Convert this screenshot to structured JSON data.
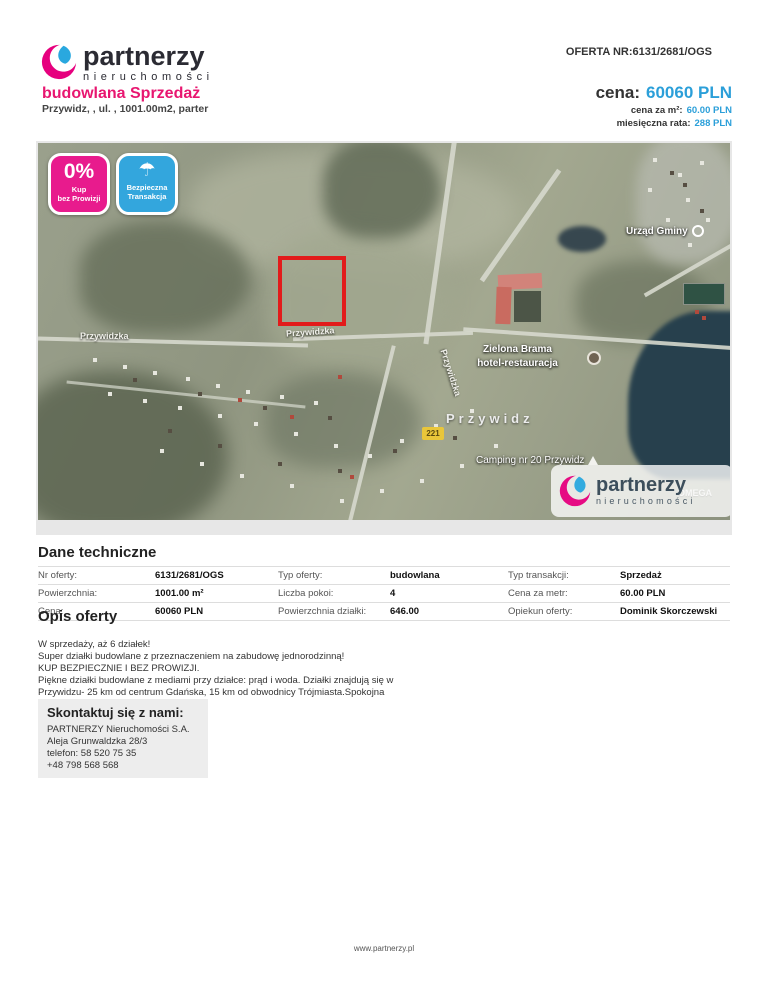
{
  "brand": {
    "name": "partnerzy",
    "subname": "nieruchomości"
  },
  "header": {
    "offer_number": "OFERTA NR:6131/2681/OGS",
    "title": "budowlana Sprzedaż",
    "subtitle": "Przywidz, , ul. , 1001.00m2, parter",
    "price_label": "cena:",
    "price_value": "60060 PLN",
    "price_per_m2_label": "cena za m²:",
    "price_per_m2_value": "60.00 PLN",
    "monthly_rate_label": "miesięczna rata:",
    "monthly_rate_value": "288 PLN"
  },
  "map": {
    "badge_no_commission": {
      "big": "0%",
      "line1": "Kup",
      "line2": "bez Prowizji"
    },
    "badge_safe": {
      "icon": "umbrella-icon",
      "umbrella": "☂",
      "line1": "Bezpieczna",
      "line2": "Transakcja"
    },
    "labels": {
      "town_office": "Urząd Gminy",
      "hotel_line1": "Zielona Brama",
      "hotel_line2": "hotel-restauracja",
      "town": "Przywidz",
      "camping": "Camping nr 20 Przywidz",
      "street_left": "Przywidzka",
      "street_mid": "Przywidzka",
      "street_vertical": "Przywidzka",
      "road_shield": "221",
      "omega": "OMEGA"
    },
    "watermark": {
      "name": "partnerzy",
      "subname": "nieruchomości"
    }
  },
  "tech": {
    "heading": "Dane techniczne",
    "rows": [
      [
        {
          "label": "Nr oferty:",
          "value": "6131/2681/OGS"
        },
        {
          "label": "Typ oferty:",
          "value": "budowlana"
        },
        {
          "label": "Typ transakcji:",
          "value": "Sprzedaż"
        }
      ],
      [
        {
          "label": "Powierzchnia:",
          "value": "1001.00 m²"
        },
        {
          "label": "Liczba pokoi:",
          "value": "4"
        },
        {
          "label": "Cena za metr:",
          "value": "60.00 PLN"
        }
      ],
      [
        {
          "label": "Cena:",
          "value": "60060 PLN"
        },
        {
          "label": "Powierzchnia działki:",
          "value": "646.00"
        },
        {
          "label": "Opiekun oferty:",
          "value": "Dominik Skorczewski"
        }
      ]
    ]
  },
  "description": {
    "heading": "Opis oferty",
    "lines": [
      "W sprzedaży, aż 6 działek!",
      "Super działki budowlane z przeznaczeniem na zabudowę jednorodzinną!",
      "KUP BEZPIECZNIE I BEZ PROWIZJI.",
      "Piękne działki budowlane z mediami przy działce: prąd i woda. Działki znajdują się w",
      "Przywidzu- 25 km od centrum Gdańska, 15 km od obwodnicy Trójmiasta.Spokojna",
      "okolica idealne..."
    ]
  },
  "contact": {
    "heading": "Skontaktuj się z nami:",
    "lines": [
      "PARTNERZY Nieruchomości S.A.",
      "Aleja Grunwaldzka 28/3",
      "telefon: 58 520 75 35",
      "+48 798 568 568"
    ]
  },
  "footer": {
    "url": "www.partnerzy.pl"
  },
  "colors": {
    "brand_pink": "#e6007e",
    "brand_blue": "#29a8df",
    "title_pink": "#e81670",
    "price_blue": "#2b9fd9",
    "plot_outline_red": "#e21b1b"
  }
}
